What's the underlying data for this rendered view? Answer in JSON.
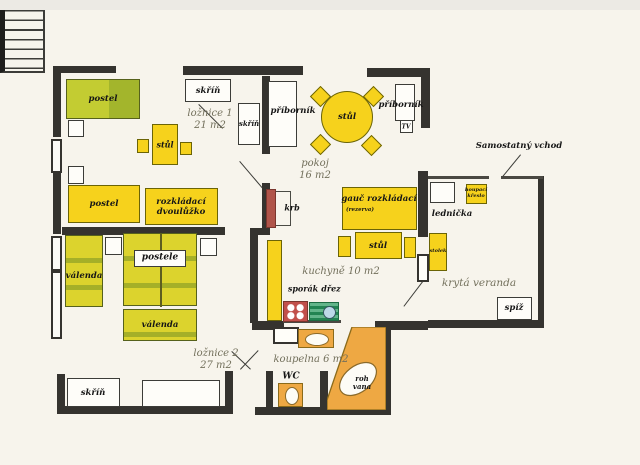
{
  "plan_title": "apartment floor plan (scanned, Czech labels)",
  "colors": {
    "background": "#f7f4ec",
    "wall": "#35332f",
    "furniture_yellow": "#f6d21c",
    "bed_green": "#dcd32d",
    "fixture_orange": "#eea843",
    "fireplace_red": "#b0544a",
    "stove_red": "#c1504b",
    "sink_green": "#2e9c63",
    "room_label_gray": "#73705c"
  },
  "rooms": [
    {
      "name": "loznice-1",
      "label": "ložnice 1",
      "area": "21 m2"
    },
    {
      "name": "pokoj",
      "label": "pokoj",
      "area": "16 m2"
    },
    {
      "name": "loznice-2",
      "label": "ložnice 2",
      "area": "27 m2"
    },
    {
      "name": "kuchyne",
      "label": "kuchyně 10 m2"
    },
    {
      "name": "koupelna",
      "label": "koupelna 6 m2"
    },
    {
      "name": "kryta-veranda",
      "label": "krytá veranda"
    }
  ],
  "walls": [
    {
      "x": 53,
      "y": 66,
      "w": 63,
      "h": 7,
      "style": "solid"
    },
    {
      "x": 53,
      "y": 66,
      "w": 8,
      "h": 71,
      "style": "solid"
    },
    {
      "x": 51,
      "y": 139,
      "w": 11,
      "h": 34,
      "style": "hollow"
    },
    {
      "x": 53,
      "y": 173,
      "w": 8,
      "h": 61,
      "style": "solid"
    },
    {
      "x": 51,
      "y": 236,
      "w": 11,
      "h": 35,
      "style": "hollow"
    },
    {
      "x": 51,
      "y": 271,
      "w": 11,
      "h": 68,
      "style": "hollow"
    },
    {
      "x": 57,
      "y": 374,
      "w": 8,
      "h": 38,
      "style": "solid"
    },
    {
      "x": 57,
      "y": 406,
      "w": 176,
      "h": 8,
      "style": "solid"
    },
    {
      "x": 225,
      "y": 371,
      "w": 8,
      "h": 43,
      "style": "solid"
    },
    {
      "x": 183,
      "y": 66,
      "w": 120,
      "h": 9,
      "style": "solid"
    },
    {
      "x": 367,
      "y": 68,
      "w": 63,
      "h": 9,
      "style": "solid"
    },
    {
      "x": 421,
      "y": 68,
      "w": 9,
      "h": 60,
      "style": "solid"
    },
    {
      "x": 262,
      "y": 76,
      "w": 8,
      "h": 78,
      "style": "solid"
    },
    {
      "x": 262,
      "y": 183,
      "w": 8,
      "h": 52,
      "style": "solid"
    },
    {
      "x": 250,
      "y": 228,
      "w": 14,
      "h": 7,
      "style": "solid"
    },
    {
      "x": 250,
      "y": 230,
      "w": 8,
      "h": 93,
      "style": "solid"
    },
    {
      "x": 62,
      "y": 227,
      "w": 163,
      "h": 8,
      "style": "solid"
    },
    {
      "x": 252,
      "y": 321,
      "w": 32,
      "h": 9,
      "style": "solid"
    },
    {
      "x": 255,
      "y": 407,
      "w": 135,
      "h": 8,
      "style": "solid"
    },
    {
      "x": 384,
      "y": 329,
      "w": 7,
      "h": 86,
      "style": "solid"
    },
    {
      "x": 375,
      "y": 321,
      "w": 53,
      "h": 9,
      "style": "solid"
    },
    {
      "x": 418,
      "y": 171,
      "w": 10,
      "h": 66,
      "style": "solid"
    },
    {
      "x": 538,
      "y": 176,
      "w": 6,
      "h": 151,
      "style": "solid"
    },
    {
      "x": 428,
      "y": 320,
      "w": 116,
      "h": 8,
      "style": "solid"
    },
    {
      "x": 266,
      "y": 371,
      "w": 7,
      "h": 41,
      "style": "solid"
    },
    {
      "x": 320,
      "y": 371,
      "w": 8,
      "h": 41,
      "style": "solid"
    },
    {
      "x": 428,
      "y": 176,
      "w": 61,
      "h": 3,
      "style": "thin"
    },
    {
      "x": 501,
      "y": 176,
      "w": 42,
      "h": 3,
      "style": "thin"
    },
    {
      "x": 283,
      "y": 320,
      "w": 58,
      "h": 3,
      "style": "thin"
    }
  ],
  "doors": [
    {
      "name": "veranda-door-leaf",
      "x": 417,
      "y": 254,
      "w": 12,
      "h": 28
    },
    {
      "name": "bathroom-door-leaf",
      "x": 273,
      "y": 327,
      "w": 26,
      "h": 17
    }
  ],
  "door_swing_lines": [
    {
      "name": "loznice1-door-swing",
      "x1": 199,
      "y1": 104,
      "x2": 223,
      "y2": 128
    },
    {
      "name": "hall-kitchen-door-swing",
      "x1": 240,
      "y1": 161,
      "x2": 263,
      "y2": 188
    },
    {
      "name": "loznice2-door-swing",
      "x1": 232,
      "y1": 351,
      "x2": 251,
      "y2": 369
    },
    {
      "name": "bath-door-swing",
      "x1": 240,
      "y1": 369,
      "x2": 258,
      "y2": 350
    },
    {
      "name": "veranda-door-swing",
      "x1": 423,
      "y1": 282,
      "x2": 404,
      "y2": 307
    },
    {
      "name": "entrance-arrow",
      "x1": 521,
      "y1": 155,
      "x2": 503,
      "y2": 177
    }
  ],
  "furniture": [
    {
      "name": "bed-postel-1",
      "kind": "rect",
      "fill": "bedolive",
      "x": 66,
      "y": 79,
      "w": 74,
      "h": 40
    },
    {
      "name": "nightstand-1",
      "kind": "rect",
      "fill": "white",
      "x": 68,
      "y": 120,
      "w": 16,
      "h": 17
    },
    {
      "name": "table-stul-loznice1",
      "kind": "rect",
      "fill": "yellow",
      "x": 152,
      "y": 124,
      "w": 26,
      "h": 41
    },
    {
      "name": "chair-1",
      "kind": "rect",
      "fill": "yellow",
      "x": 137,
      "y": 139,
      "w": 12,
      "h": 14
    },
    {
      "name": "chair-2",
      "kind": "rect",
      "fill": "yellow",
      "x": 180,
      "y": 142,
      "w": 12,
      "h": 13
    },
    {
      "name": "wardrobe-skrin-top",
      "kind": "rect",
      "fill": "white",
      "x": 185,
      "y": 79,
      "w": 46,
      "h": 23
    },
    {
      "name": "wardrobe-skrin-vertical",
      "kind": "rect",
      "fill": "white",
      "x": 238,
      "y": 103,
      "w": 22,
      "h": 42
    },
    {
      "name": "sideboard-pribornik-1",
      "kind": "rect",
      "fill": "white",
      "x": 268,
      "y": 81,
      "w": 29,
      "h": 66
    },
    {
      "name": "round-table-stul",
      "kind": "circle",
      "fill": "yellow",
      "x": 321,
      "y": 91,
      "w": 52,
      "h": 52
    },
    {
      "name": "chair-diamond-1",
      "kind": "diamond",
      "fill": "yellow",
      "x": 313,
      "y": 89,
      "w": 15,
      "h": 15
    },
    {
      "name": "chair-diamond-2",
      "kind": "diamond",
      "fill": "yellow",
      "x": 366,
      "y": 89,
      "w": 15,
      "h": 15
    },
    {
      "name": "chair-diamond-3",
      "kind": "diamond",
      "fill": "yellow",
      "x": 313,
      "y": 137,
      "w": 15,
      "h": 15
    },
    {
      "name": "chair-diamond-4",
      "kind": "diamond",
      "fill": "yellow",
      "x": 364,
      "y": 138,
      "w": 15,
      "h": 15
    },
    {
      "name": "sideboard-pribornik-2",
      "kind": "rect",
      "fill": "white",
      "x": 395,
      "y": 84,
      "w": 20,
      "h": 37
    },
    {
      "name": "tv-stand",
      "kind": "rect",
      "fill": "white",
      "x": 400,
      "y": 120,
      "w": 13,
      "h": 13
    },
    {
      "name": "bed-postel-2",
      "kind": "rect",
      "fill": "yellow",
      "x": 68,
      "y": 185,
      "w": 72,
      "h": 38
    },
    {
      "name": "nightstand-2",
      "kind": "rect",
      "fill": "white",
      "x": 68,
      "y": 166,
      "w": 16,
      "h": 18
    },
    {
      "name": "folding-double-bed",
      "kind": "rect",
      "fill": "yellow",
      "x": 145,
      "y": 188,
      "w": 73,
      "h": 37
    },
    {
      "name": "fireplace-krb",
      "kind": "rect",
      "fill": "krbred",
      "x": 266,
      "y": 189,
      "w": 10,
      "h": 39
    },
    {
      "name": "sofa-gauc",
      "kind": "rect",
      "fill": "yellow",
      "x": 342,
      "y": 187,
      "w": 75,
      "h": 43
    },
    {
      "name": "table-stul-living",
      "kind": "rect",
      "fill": "yellow",
      "x": 355,
      "y": 232,
      "w": 47,
      "h": 27
    },
    {
      "name": "chair-3",
      "kind": "rect",
      "fill": "yellow",
      "x": 338,
      "y": 236,
      "w": 13,
      "h": 21
    },
    {
      "name": "chair-4",
      "kind": "rect",
      "fill": "yellow",
      "x": 404,
      "y": 237,
      "w": 12,
      "h": 21
    },
    {
      "name": "side-table-stolek",
      "kind": "rect",
      "fill": "yellow",
      "x": 429,
      "y": 233,
      "w": 18,
      "h": 38
    },
    {
      "name": "fridge-lednicka",
      "kind": "rect",
      "fill": "white",
      "x": 430,
      "y": 182,
      "w": 25,
      "h": 21
    },
    {
      "name": "rocking-chair",
      "kind": "rect",
      "fill": "yellow",
      "x": 466,
      "y": 184,
      "w": 21,
      "h": 20
    },
    {
      "name": "kitchen-counter",
      "kind": "rect",
      "fill": "yellow",
      "x": 267,
      "y": 240,
      "w": 15,
      "h": 81
    },
    {
      "name": "stove-sporak",
      "kind": "stove",
      "x": 283,
      "y": 301,
      "w": 25,
      "h": 21
    },
    {
      "name": "sink-drez",
      "kind": "sink",
      "x": 309,
      "y": 302,
      "w": 30,
      "h": 19
    },
    {
      "name": "washbasin",
      "kind": "basin",
      "x": 298,
      "y": 329,
      "w": 36,
      "h": 19,
      "ew": 24,
      "eh": 13
    },
    {
      "name": "toilet-bowl",
      "kind": "basin",
      "x": 278,
      "y": 383,
      "w": 25,
      "h": 24,
      "ew": 14,
      "eh": 18
    },
    {
      "name": "corner-bath-vana",
      "kind": "vana",
      "x": 327,
      "y": 327,
      "w": 59,
      "h": 83,
      "points": "25,0 59,0 59,83 0,83 0,73",
      "ellipse": {
        "cx": 31,
        "cy": 52,
        "rx": 21,
        "ry": 13,
        "rot": -38
      }
    },
    {
      "name": "pantry-spiz",
      "kind": "rect",
      "fill": "white",
      "x": 497,
      "y": 297,
      "w": 35,
      "h": 23
    },
    {
      "name": "daybed-valenda-left",
      "kind": "rect",
      "fill": "bedgreen",
      "x": 65,
      "y": 235,
      "w": 38,
      "h": 72
    },
    {
      "name": "nightstand-3",
      "kind": "rect",
      "fill": "white",
      "x": 105,
      "y": 237,
      "w": 17,
      "h": 18
    },
    {
      "name": "nightstand-4",
      "kind": "rect",
      "fill": "white",
      "x": 200,
      "y": 238,
      "w": 17,
      "h": 18
    },
    {
      "name": "double-bed-postele",
      "kind": "rect",
      "fill": "bedgreen",
      "x": 123,
      "y": 233,
      "w": 74,
      "h": 73,
      "divider": true
    },
    {
      "name": "postele-label-plate",
      "kind": "rect",
      "fill": "white",
      "x": 134,
      "y": 250,
      "w": 52,
      "h": 17
    },
    {
      "name": "daybed-valenda-bottom",
      "kind": "rect",
      "fill": "bedgreen",
      "x": 123,
      "y": 309,
      "w": 74,
      "h": 32
    },
    {
      "name": "wardrobe-skrin-bottom",
      "kind": "rect",
      "fill": "white",
      "x": 67,
      "y": 378,
      "w": 53,
      "h": 29
    },
    {
      "name": "storage-box",
      "kind": "rect",
      "fill": "white",
      "x": 142,
      "y": 380,
      "w": 78,
      "h": 27
    },
    {
      "name": "staircase",
      "kind": "stairs",
      "x": 496,
      "y": 179,
      "w": 45,
      "h": 73
    }
  ],
  "fireplace_bracket": {
    "x": 276,
    "y": 191,
    "w": 15,
    "h": 35
  },
  "texts": [
    {
      "name": "label-postel-1",
      "lines": [
        "postel"
      ],
      "x": 103,
      "y": 99,
      "size": 8.5,
      "cls": "b"
    },
    {
      "name": "label-skrin-top",
      "lines": [
        "skříň"
      ],
      "x": 208,
      "y": 91,
      "size": 8.5,
      "cls": "b"
    },
    {
      "name": "label-loznice-1",
      "lines": [
        "ložnice 1",
        "21 m2"
      ],
      "x": 210,
      "y": 120,
      "size": 10,
      "cls": "gray"
    },
    {
      "name": "label-skrin-vertical",
      "lines": [
        "skříň"
      ],
      "x": 249,
      "y": 124,
      "size": 7,
      "cls": "b"
    },
    {
      "name": "label-pribornik-1",
      "lines": [
        "příborník"
      ],
      "x": 293,
      "y": 111,
      "size": 8.5,
      "cls": "b"
    },
    {
      "name": "label-stul-loznice1",
      "lines": [
        "stůl"
      ],
      "x": 165,
      "y": 145,
      "size": 8,
      "cls": "b"
    },
    {
      "name": "label-stul-round",
      "lines": [
        "stůl"
      ],
      "x": 347,
      "y": 117,
      "size": 8.5,
      "cls": "b"
    },
    {
      "name": "label-pribornik-2",
      "lines": [
        "příborník"
      ],
      "x": 401,
      "y": 105,
      "size": 8.5,
      "cls": "b"
    },
    {
      "name": "label-tv",
      "lines": [
        "TV"
      ],
      "x": 406,
      "y": 127,
      "size": 6,
      "cls": "b"
    },
    {
      "name": "label-pokoj",
      "lines": [
        "pokoj",
        "16 m2"
      ],
      "x": 315,
      "y": 170,
      "size": 10,
      "cls": "gray"
    },
    {
      "name": "label-postel-2",
      "lines": [
        "postel"
      ],
      "x": 104,
      "y": 204,
      "size": 8.5,
      "cls": "b"
    },
    {
      "name": "label-rozkladaci",
      "lines": [
        "rozkládací",
        "dvoulůžko"
      ],
      "x": 181,
      "y": 207,
      "size": 8.5,
      "cls": "b"
    },
    {
      "name": "label-samostatny-vchod",
      "lines": [
        "Samostatný vchod"
      ],
      "x": 519,
      "y": 146,
      "size": 8.5,
      "cls": "b"
    },
    {
      "name": "label-krb",
      "lines": [
        "krb"
      ],
      "x": 292,
      "y": 208,
      "size": 8,
      "cls": "b"
    },
    {
      "name": "label-gauc",
      "lines": [
        "gauč rozkládací"
      ],
      "x": 379,
      "y": 199,
      "size": 8.5,
      "cls": "b"
    },
    {
      "name": "label-rezerva",
      "lines": [
        "(rezerva)"
      ],
      "x": 360,
      "y": 210,
      "size": 5.5,
      "cls": "b"
    },
    {
      "name": "label-lednicka",
      "lines": [
        "lednička"
      ],
      "x": 452,
      "y": 214,
      "size": 8.5,
      "cls": "b"
    },
    {
      "name": "label-houpaci",
      "lines": [
        "houpací",
        "křeslo"
      ],
      "x": 476,
      "y": 194,
      "size": 5,
      "cls": "b"
    },
    {
      "name": "label-stul-living",
      "lines": [
        "stůl"
      ],
      "x": 378,
      "y": 246,
      "size": 8.5,
      "cls": "b"
    },
    {
      "name": "label-stolek",
      "lines": [
        "stolek"
      ],
      "x": 438,
      "y": 252,
      "size": 5,
      "cls": "b"
    },
    {
      "name": "label-kuchyne",
      "lines": [
        "kuchyně 10 m2"
      ],
      "x": 341,
      "y": 272,
      "size": 10,
      "cls": "gray"
    },
    {
      "name": "label-sporak",
      "lines": [
        "sporák"
      ],
      "x": 303,
      "y": 289,
      "size": 8,
      "cls": "b"
    },
    {
      "name": "label-drez",
      "lines": [
        "dřez"
      ],
      "x": 331,
      "y": 289,
      "size": 8,
      "cls": "b"
    },
    {
      "name": "label-kryta-veranda",
      "lines": [
        "krytá veranda"
      ],
      "x": 479,
      "y": 283,
      "size": 10.5,
      "cls": "gray"
    },
    {
      "name": "label-spiz",
      "lines": [
        "spíž"
      ],
      "x": 514,
      "y": 308,
      "size": 8.5,
      "cls": "b"
    },
    {
      "name": "label-valenda-left",
      "lines": [
        "válenda"
      ],
      "x": 84,
      "y": 276,
      "size": 8.5,
      "cls": "b"
    },
    {
      "name": "label-postele",
      "lines": [
        "postele"
      ],
      "x": 160,
      "y": 258,
      "size": 9,
      "cls": "b"
    },
    {
      "name": "label-valenda-bottom",
      "lines": [
        "válenda"
      ],
      "x": 160,
      "y": 325,
      "size": 8.5,
      "cls": "b"
    },
    {
      "name": "label-loznice-2",
      "lines": [
        "ložnice 2",
        "27 m2"
      ],
      "x": 216,
      "y": 360,
      "size": 10,
      "cls": "gray"
    },
    {
      "name": "label-koupelna",
      "lines": [
        "koupelna 6 m2"
      ],
      "x": 311,
      "y": 360,
      "size": 10,
      "cls": "gray"
    },
    {
      "name": "label-wc",
      "lines": [
        "WC"
      ],
      "x": 291,
      "y": 377,
      "size": 9,
      "cls": "b"
    },
    {
      "name": "label-roh-vana",
      "lines": [
        "roh",
        "vana"
      ],
      "x": 362,
      "y": 383,
      "size": 7,
      "cls": "b"
    },
    {
      "name": "label-skrin-bottom",
      "lines": [
        "skříň"
      ],
      "x": 93,
      "y": 393,
      "size": 8.5,
      "cls": "b"
    }
  ]
}
